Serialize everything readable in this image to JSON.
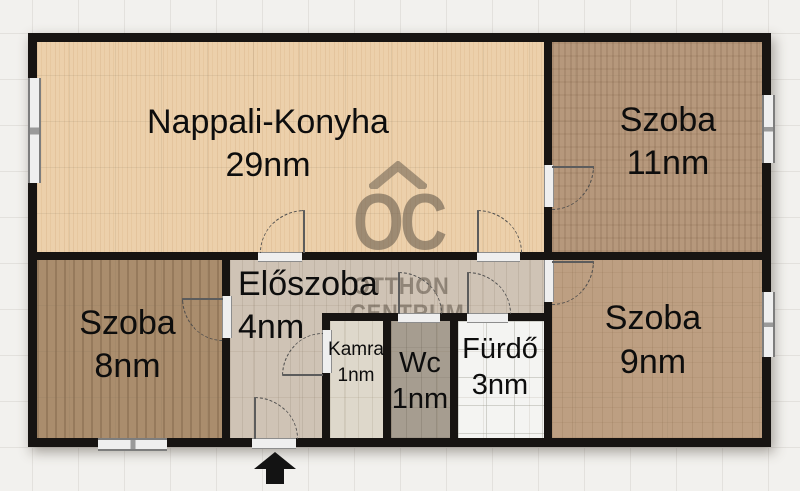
{
  "plan": {
    "rooms": {
      "nappali": {
        "name": "Nappali-Konyha",
        "area": "29nm"
      },
      "szoba11": {
        "name": "Szoba",
        "area": "11nm"
      },
      "szoba8": {
        "name": "Szoba",
        "area": "8nm"
      },
      "eloszoba": {
        "name": "Előszoba",
        "area": "4nm"
      },
      "kamra": {
        "name": "Kamra",
        "area": "1nm"
      },
      "wc": {
        "name": "Wc",
        "area": "1nm"
      },
      "furdo": {
        "name": "Fürdő",
        "area": "3nm"
      },
      "szoba9": {
        "name": "Szoba",
        "area": "9nm"
      }
    },
    "watermark": {
      "logo": "OC",
      "line1": "OTTHON",
      "line2": "CENTRUM"
    },
    "colors": {
      "wall": "#171412",
      "paper": "#f2f1ee",
      "nappali_floor": "#ecd0ab",
      "szoba11_floor": "#b6987c",
      "szoba8_floor": "#aa8d6d",
      "szoba9_floor": "#bd9f82",
      "eloszoba_floor": "#cfc3b5",
      "kamra_floor": "#ded8cb",
      "wc_floor": "#a69d90",
      "furdo_floor": "#f4f4f2",
      "watermark": "rgba(92,82,70,0.55)"
    }
  }
}
